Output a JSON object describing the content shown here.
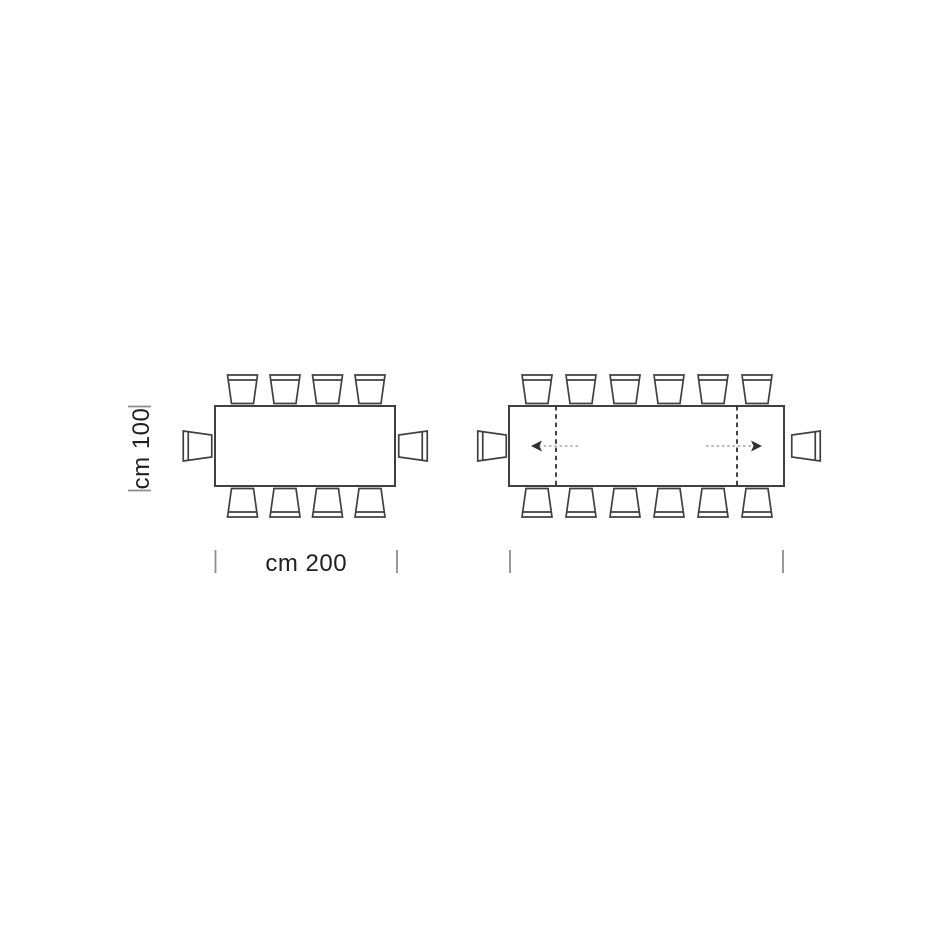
{
  "page": {
    "background": "#ffffff"
  },
  "diagram": {
    "title": "Rectangular extending table - seating plan top view",
    "colors": {
      "line": "#404040",
      "leaf": "#2f2f2f",
      "tick": "#8e8e8e",
      "arrow_shaft": "#a3a3a3",
      "text": "#1f1f1f",
      "fill": "#ffffff"
    },
    "tables": [
      {
        "id": "table-closed",
        "seats": 10,
        "rect": {
          "x": 215,
          "y": 406,
          "w": 180,
          "h": 80
        },
        "chairs_top_cx": [
          242.5,
          285,
          327.5,
          370
        ],
        "chairs_bottom_cx": [
          242.5,
          285,
          327.5,
          370
        ],
        "chair_left_cx": 197.5,
        "chair_right_cx": 413,
        "v_dim": {
          "label": "cm 100",
          "label_x": 141.5,
          "tick_x1": 128,
          "tick_x2": 151,
          "y1": 406.5,
          "y2": 490.5
        },
        "h_dim": {
          "label": "cm 200",
          "label_y": 571,
          "x1": 215.5,
          "x2": 397,
          "tick_y1": 550,
          "tick_y2": 573
        }
      },
      {
        "id": "table-extended",
        "seats": 14,
        "rect": {
          "x": 509,
          "y": 406,
          "w": 275,
          "h": 80
        },
        "chairs_top_cx": [
          537,
          581,
          625,
          669,
          713,
          757
        ],
        "chairs_bottom_cx": [
          537,
          581,
          625,
          669,
          713,
          757
        ],
        "chair_left_cx": 492,
        "chair_right_cx": 806,
        "leaf_lines_x": [
          556,
          737
        ],
        "arrows": [
          {
            "dir": "left",
            "tip_x": 531,
            "tail_x": 578,
            "y": 446
          },
          {
            "dir": "right",
            "tip_x": 762,
            "tail_x": 706,
            "y": 446
          }
        ],
        "h_dim": {
          "label": "",
          "x1": 510,
          "x2": 783,
          "tick_y1": 550,
          "tick_y2": 573
        }
      }
    ]
  }
}
